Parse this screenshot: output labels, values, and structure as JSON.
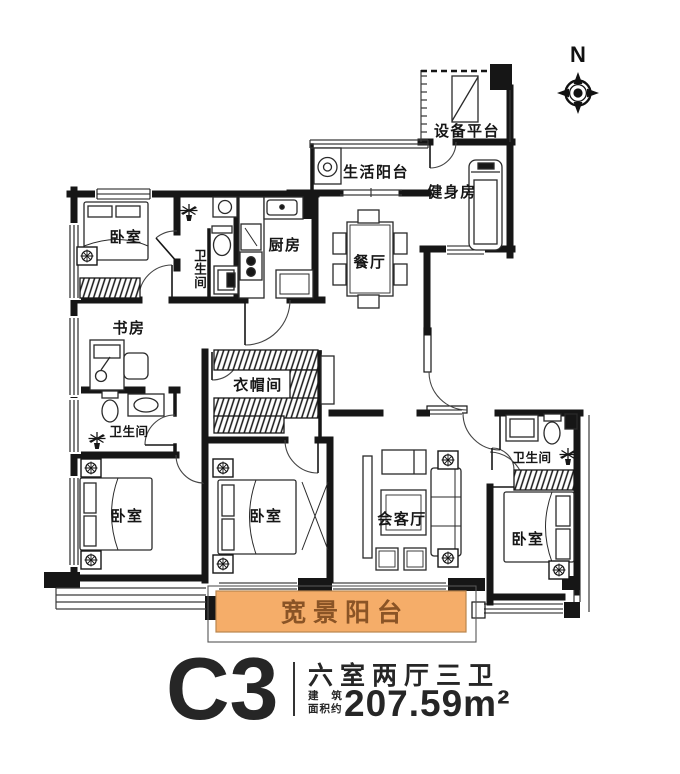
{
  "compass": {
    "north_label": "N"
  },
  "rooms": {
    "bedroom_nw": "卧室",
    "bath_ensuite": "卫生间",
    "kitchen": "厨房",
    "service_balcony": "生活阳台",
    "equipment_platform": "设备平台",
    "gym": "健身房",
    "dining": "餐厅",
    "study": "书房",
    "cloakroom": "衣帽间",
    "bath_master": "卫生间",
    "bedroom_sw": "卧室",
    "bedroom_s": "卧室",
    "living": "会客厅",
    "bath_east": "卫生间",
    "bedroom_se": "卧室",
    "view_balcony": "宽景阳台"
  },
  "title_block": {
    "unit_code": "C3",
    "layout_summary": "六室两厅三卫",
    "area_label_line1": "建 筑",
    "area_label_line2": "面积约",
    "area_value": "207.59m²"
  },
  "colors": {
    "wall": "#161616",
    "balcony_fill": "#f5ad69",
    "balcony_text": "#8a5426",
    "title_text": "#262626"
  }
}
